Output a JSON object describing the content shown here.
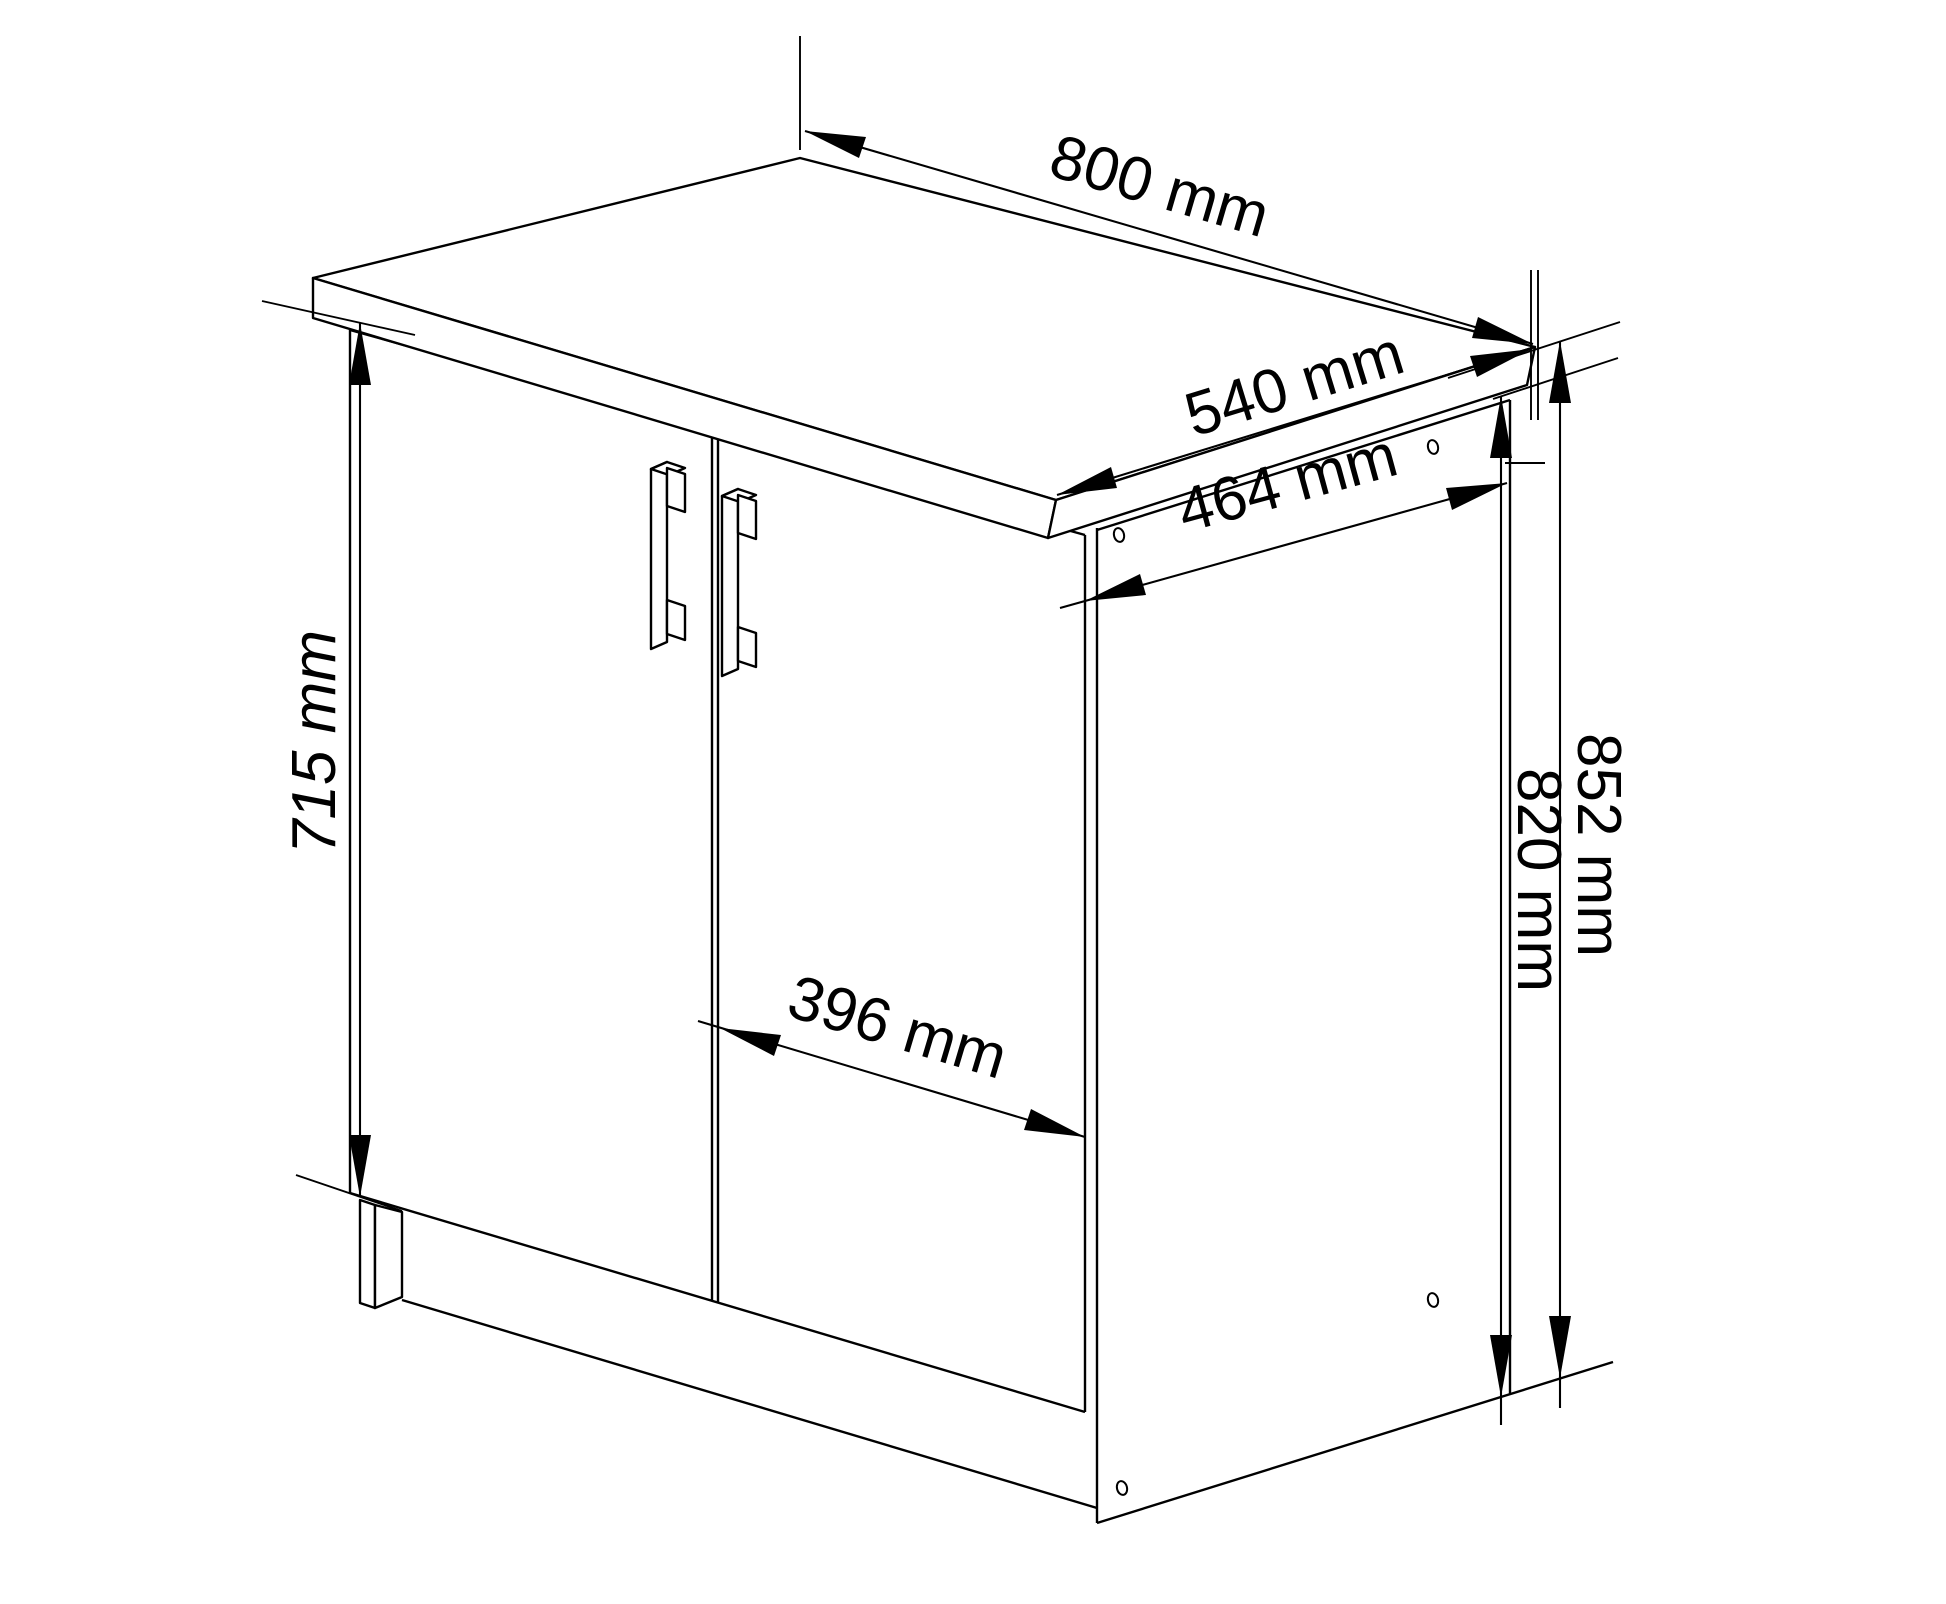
{
  "page": {
    "background": "#ffffff",
    "line_color": "#000000"
  },
  "drawing": {
    "type": "isometric-technical-drawing",
    "subject": "two-door base cabinet with countertop",
    "unit": "mm",
    "dimensions": {
      "top_width": {
        "value": 800,
        "unit": "mm",
        "label": "800 mm"
      },
      "top_depth": {
        "value": 540,
        "unit": "mm",
        "label": "540 mm"
      },
      "carcass_depth": {
        "value": 464,
        "unit": "mm",
        "label": "464 mm"
      },
      "door_height": {
        "value": 715,
        "unit": "mm",
        "label": "715 mm"
      },
      "door_width": {
        "value": 396,
        "unit": "mm",
        "label": "396 mm"
      },
      "total_height": {
        "value": 852,
        "unit": "mm",
        "label": "852 mm"
      },
      "carcass_height": {
        "value": 820,
        "unit": "mm",
        "label": "820 mm"
      }
    }
  }
}
